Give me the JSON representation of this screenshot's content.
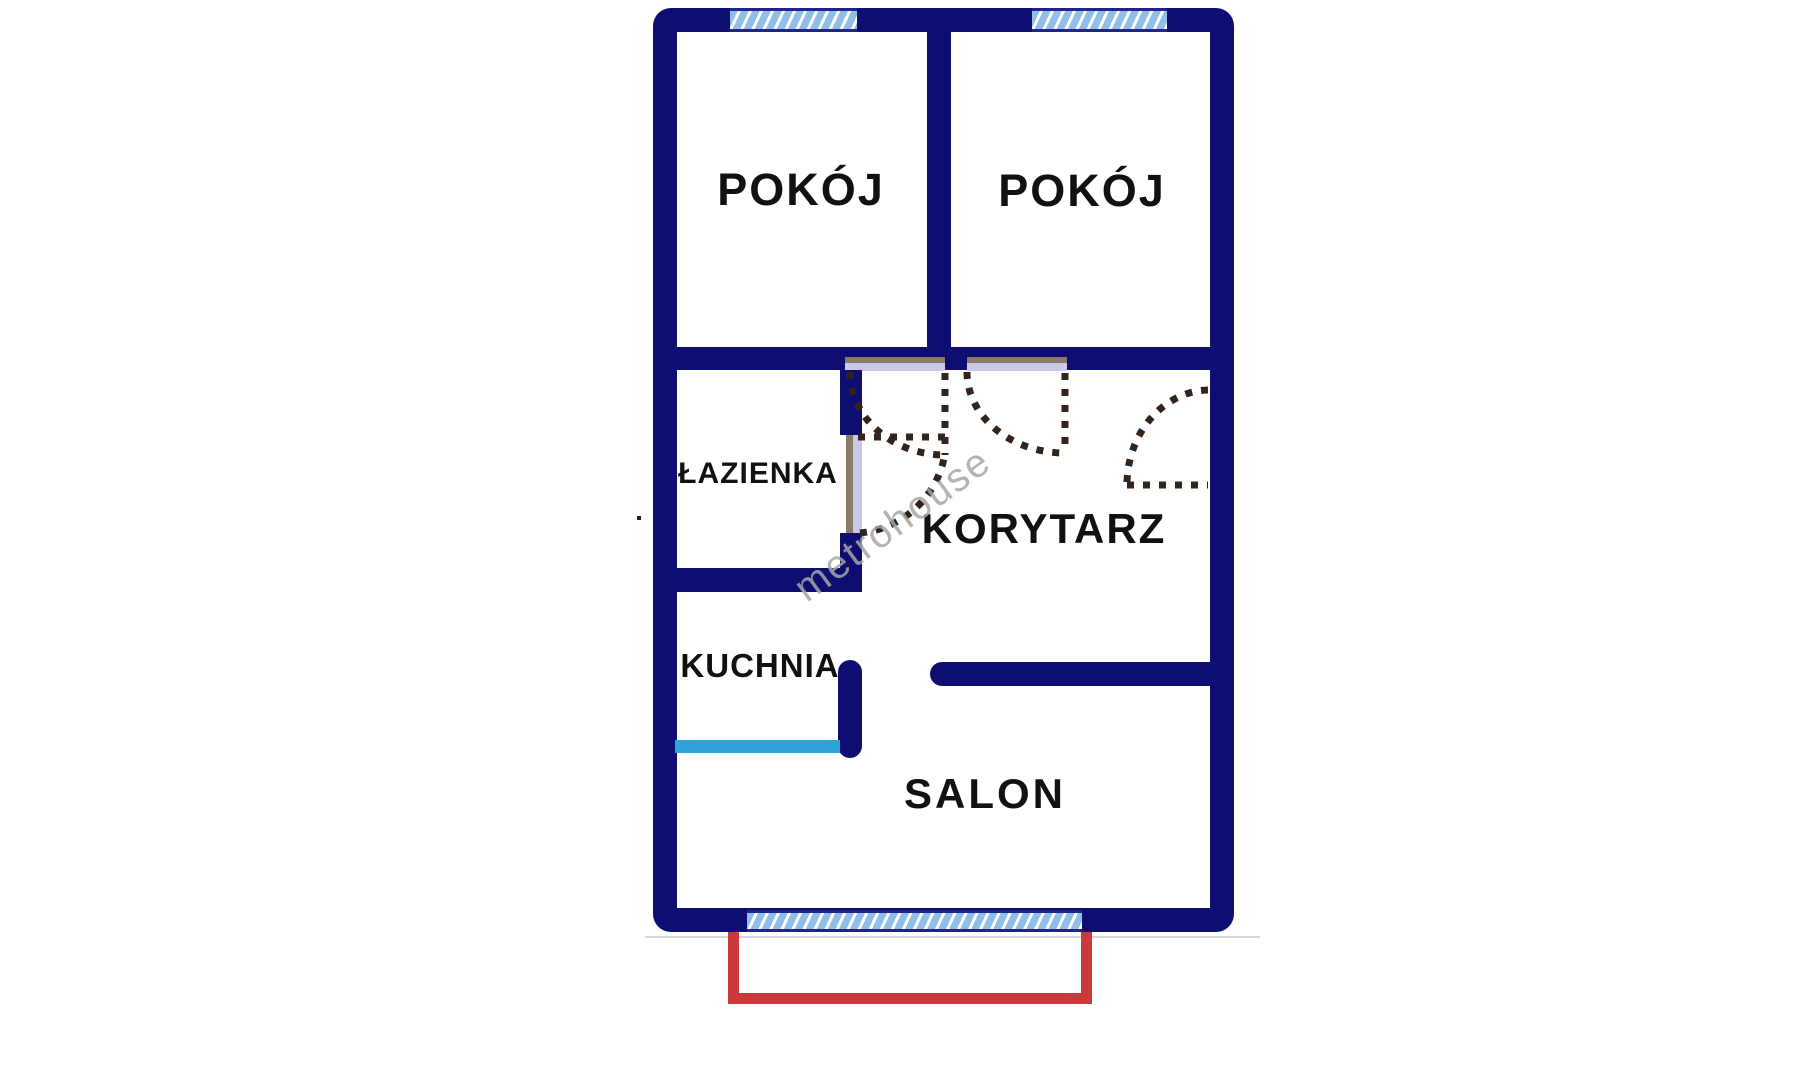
{
  "plan": {
    "type": "apartment-floor-plan",
    "watermark": "metrohouse",
    "rooms": [
      {
        "id": "pokoj-1",
        "label": "POKÓJ"
      },
      {
        "id": "pokoj-2",
        "label": "POKÓJ"
      },
      {
        "id": "lazienka",
        "label": "ŁAZIENKA"
      },
      {
        "id": "korytarz",
        "label": "KORYTARZ"
      },
      {
        "id": "kuchnia",
        "label": "KUCHNIA"
      },
      {
        "id": "salon",
        "label": "SALON"
      }
    ],
    "features": {
      "windows": 3,
      "doors": 4,
      "balcony": true,
      "kitchen_counter_line": true
    },
    "colors": {
      "wall_navy": "#0d0d72",
      "window_fill": "#8fbfe8",
      "window_stripe": "#ffffff",
      "window_edge": "#23238c",
      "door_jamb_tan": "#8a7a68",
      "door_opening_lavender": "#c9c9e6",
      "door_swing_dash": "#32241c",
      "balcony_red": "#c93b3b",
      "counter_cyan": "#2ea3d9",
      "label_text": "#111111",
      "watermark_gray": "#a6a6a6",
      "background": "#ffffff"
    }
  }
}
